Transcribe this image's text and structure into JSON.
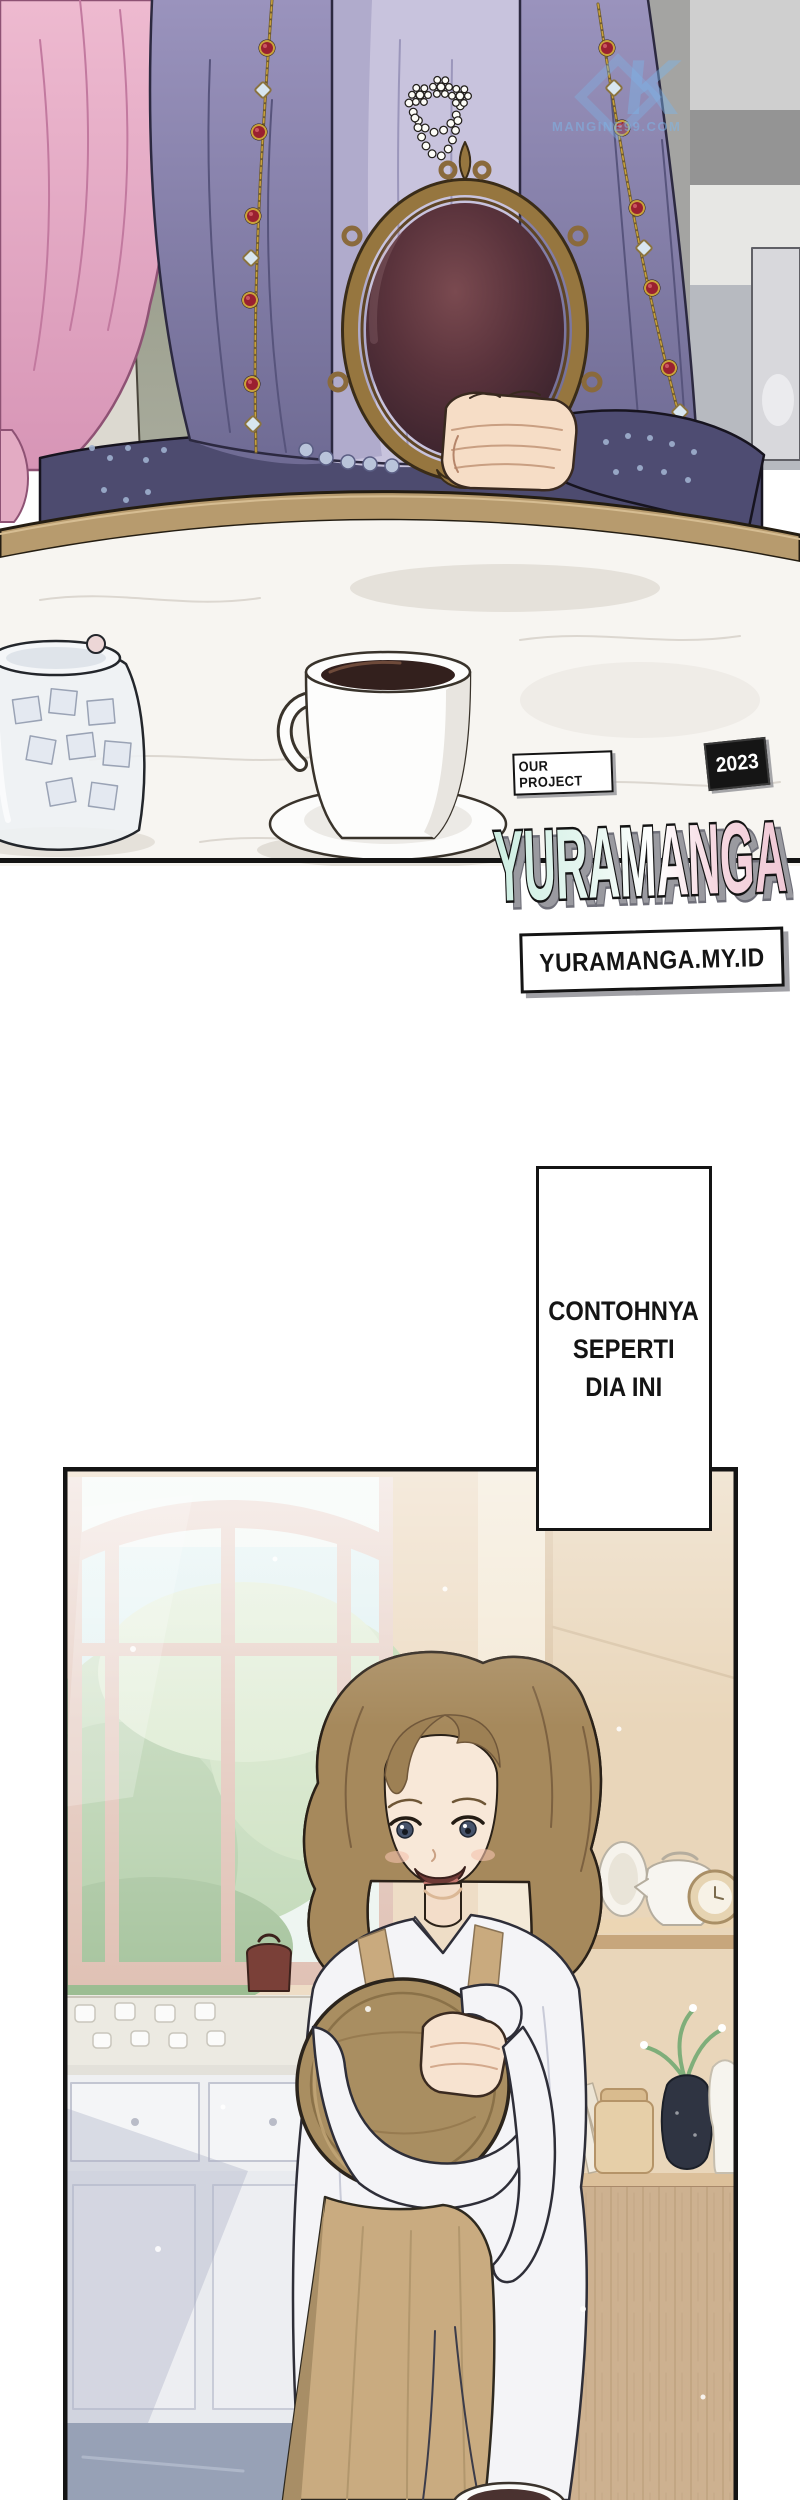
{
  "page": {
    "width": 800,
    "height": 2500,
    "background": "#ffffff"
  },
  "panel1": {
    "label": "lady holding ornate hand mirror at marble table with coffee and sugar jar",
    "watermark": {
      "logo": "K",
      "site": "MANGINE99.COM"
    },
    "credit": {
      "project_label": "OUR PROJECT",
      "year": "2023",
      "title": "YURAMANGA",
      "site": "YURAMANGA.MY.ID"
    }
  },
  "speech": {
    "line1": "CONTOHNYA",
    "line2": "SEPERTI",
    "line3": "DIA INI"
  },
  "panel2": {
    "label": "woman with brown wavy hair in apron holding round wooden tray in kitchen"
  },
  "palette": {
    "ink": "#141414",
    "cloak_purple": "#8d87b2",
    "inner_lavender": "#c8c3dd",
    "hair_pink": "#e3abc3",
    "navy_dress": "#4e4c72",
    "mirror_frame_gold": "#96763f",
    "mirror_glass": "#46262e",
    "table_wood": "#b79b6e",
    "marble": "#f7f5f1",
    "coffee": "#33201d",
    "logo_mint": "#cdeee2",
    "logo_pink": "#f0c9d6",
    "watermark_blue": "#7db4e6",
    "kitchen_wall": "#eeddc6",
    "window_frame": "#d8b5a8",
    "foliage_green": "#b9d4ae",
    "woman_hair_brown": "#a6895c",
    "apron_tan": "#c9ab80",
    "shirt_white": "#f4f4f7",
    "floor_blue": "#97a1b6"
  }
}
